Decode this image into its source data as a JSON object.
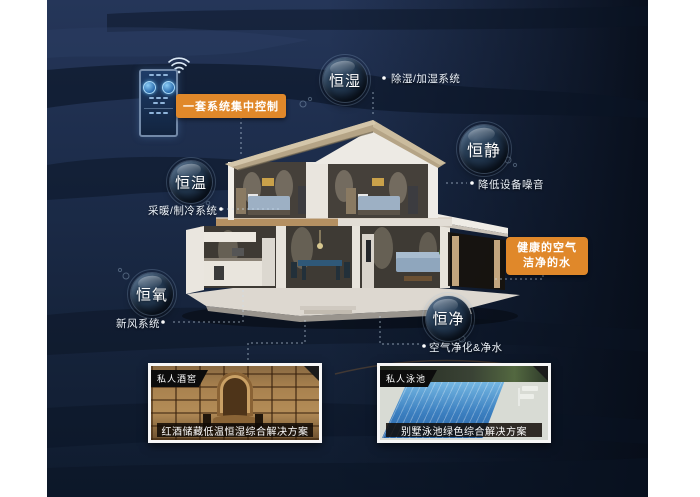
{
  "bubbles": {
    "humidity": "恒湿",
    "quiet": "恒静",
    "temperature": "恒温",
    "oxygen": "恒氧",
    "purity": "恒净"
  },
  "notes": {
    "humidity": "除湿/加湿系统",
    "quiet": "降低设备噪音",
    "temperature": "采暖/制冷系统",
    "oxygen": "新风系统",
    "purity": "空气净化&净水"
  },
  "callouts": {
    "control": "一套系统集中控制",
    "benefit_line1": "健康的空气",
    "benefit_line2": "洁净的水"
  },
  "cards": {
    "wine": {
      "tag": "私人酒窖",
      "caption": "红酒储藏低温恒湿综合解决方案"
    },
    "pool": {
      "tag": "私人泳池",
      "caption": "别墅泳池绿色综合解决方案"
    }
  },
  "icons": {
    "wifi": "wifi-icon",
    "controller": "smart-home-control-panel"
  },
  "colors": {
    "accent_orange": "#E0882A",
    "panel_navy": "#1C2B49",
    "panel_dark": "#0B1526",
    "bubble_text": "#FFFFFF",
    "note_text": "#EDF3FA"
  }
}
